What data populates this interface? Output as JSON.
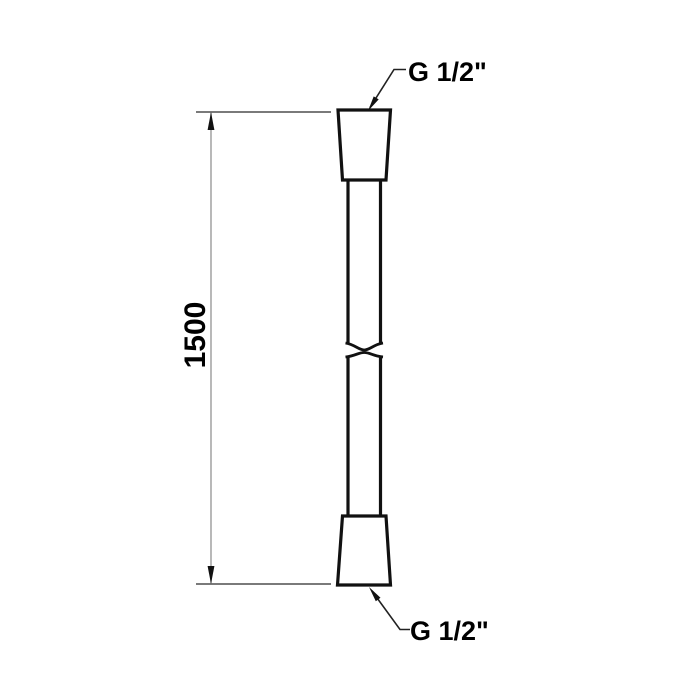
{
  "labels": {
    "dimension": "1500",
    "top_connector": "G 1/2\"",
    "bottom_connector": "G 1/2\""
  },
  "colors": {
    "background": "#ffffff",
    "outline": "#111111",
    "text": "#000000",
    "thin_line": "#4f4f4f",
    "dimension_line": "#9b9b9b",
    "arrow_fill": "#111111"
  }
}
